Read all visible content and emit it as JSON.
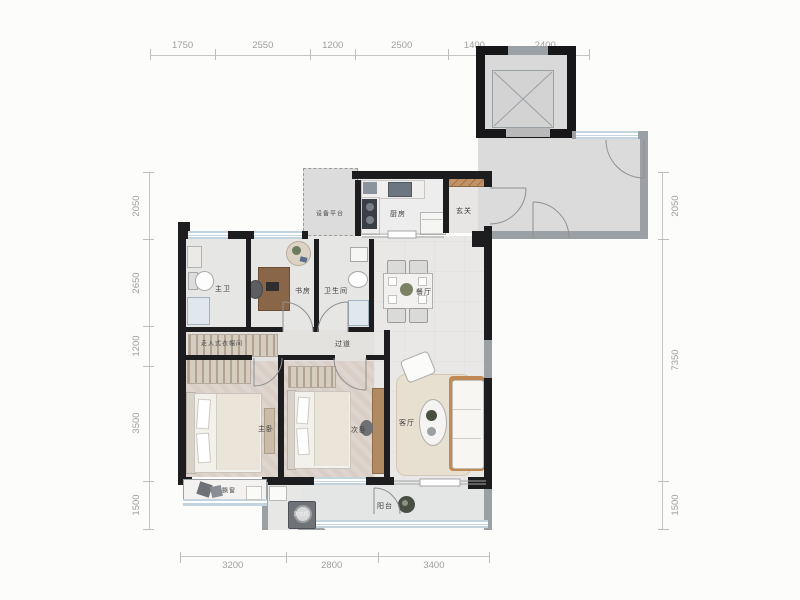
{
  "plan": {
    "rooms": {
      "master_bath": "主卫",
      "study": "书房",
      "bathroom": "卫生间",
      "equipment_platform": "设备平台",
      "kitchen": "厨房",
      "foyer": "玄关",
      "dining": "餐厅",
      "closet": "走入式衣帽间",
      "hallway": "过道",
      "master_bedroom": "主卧",
      "second_bedroom": "次卧",
      "living": "客厅",
      "bay_window": "飘窗",
      "washer": "洗衣机",
      "balcony": "阳台"
    },
    "dimensions": {
      "top": [
        "1750",
        "2550",
        "1200",
        "2500",
        "1400",
        "2400"
      ],
      "left": [
        "2050",
        "2650",
        "1200",
        "3500",
        "1500"
      ],
      "right": [
        "2050",
        "7350",
        "1500"
      ],
      "bottom": [
        "3200",
        "2800",
        "3400"
      ]
    },
    "colors": {
      "wall": "#1d1d20",
      "gray_wall": "#9aa0a4",
      "window": "#c4d4df",
      "wood_accent": "#b98d5e",
      "dim_text": "#9e9e9e"
    }
  }
}
